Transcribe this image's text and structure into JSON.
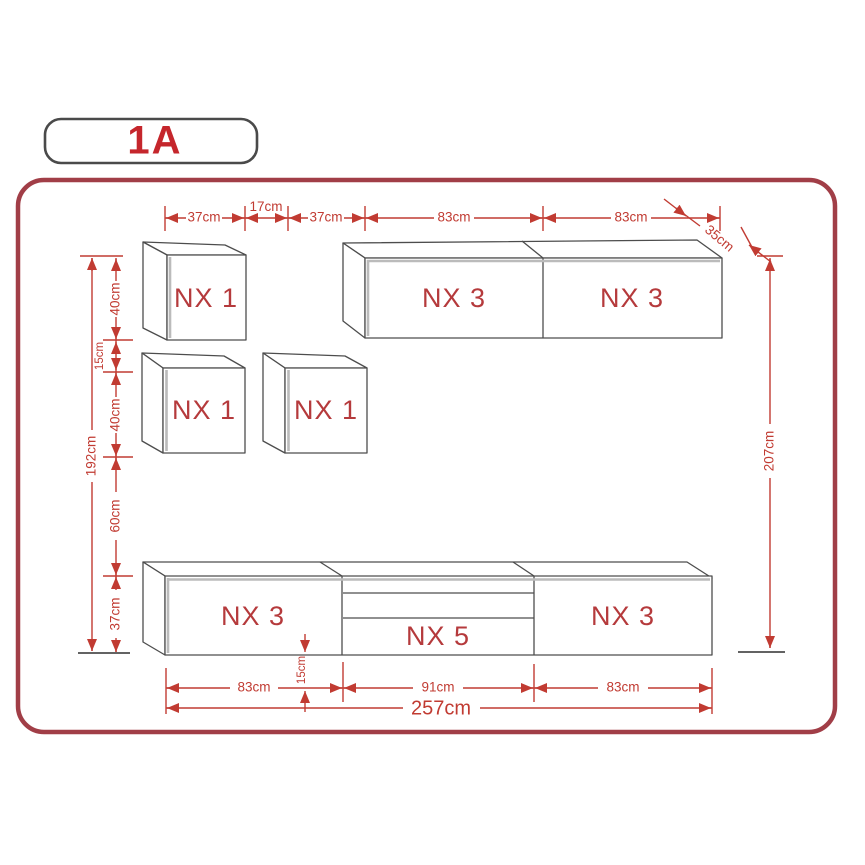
{
  "badge": {
    "label": "1A"
  },
  "boxes": {
    "wall_cube_top": "NX 1",
    "wall_cube_left": "NX 1",
    "wall_cube_right": "NX 1",
    "wall_cabinet_left": "NX 3",
    "wall_cabinet_right": "NX 3",
    "base_cabinet_left": "NX 3",
    "base_cabinet_center": "NX 5",
    "base_cabinet_right": "NX 3"
  },
  "dims": {
    "top": {
      "w1": "37cm",
      "gap": "17cm",
      "w2": "37cm",
      "w3": "83cm",
      "w4": "83cm",
      "depth": "35cm"
    },
    "left": {
      "h1": "40cm",
      "g1": "15cm",
      "h2": "40cm",
      "g2": "60cm",
      "h3": "37cm",
      "total": "192cm"
    },
    "right": {
      "total": "207cm"
    },
    "bottom": {
      "w1": "83cm",
      "leg": "15cm",
      "w2": "91cm",
      "w3": "83cm",
      "total": "257cm"
    }
  },
  "colors": {
    "dimension": "#c13b32",
    "box_label": "#b53a3c",
    "frame_border": "#a13e47",
    "badge_text": "#c5262c",
    "outline": "#4d4d4d"
  }
}
